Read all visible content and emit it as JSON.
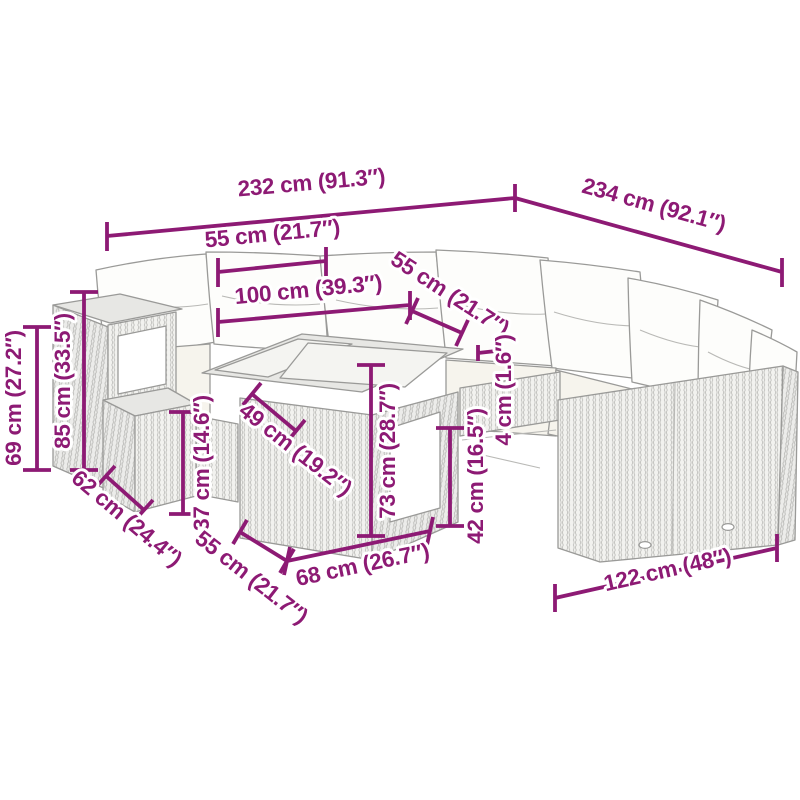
{
  "diagram": {
    "type": "furniture-dimension-diagram",
    "subject": "poly rattan garden corner sofa set with table, cushions and stool",
    "colors": {
      "accent": "#8d1a74",
      "line_art": "#9a9a98",
      "background": "#ffffff"
    },
    "dimensions": [
      {
        "name": "overall-width-left",
        "label": "232 cm (91.3″)"
      },
      {
        "name": "overall-width-right",
        "label": "234 cm (92.1″)"
      },
      {
        "name": "glass-top-width",
        "label": "55 cm (21.7″)"
      },
      {
        "name": "table-top-length",
        "label": "100 cm (39.3″)"
      },
      {
        "name": "glass-top-depth",
        "label": "55 cm (21.7″)"
      },
      {
        "name": "top-thickness",
        "label": "4 cm (1.6″)"
      },
      {
        "name": "armrest-height",
        "label": "69 cm (27.2″)"
      },
      {
        "name": "back-height",
        "label": "85 cm (33.5″)"
      },
      {
        "name": "stool-depth",
        "label": "62 cm (24.4″)"
      },
      {
        "name": "stool-height",
        "label": "37 cm (14.6″)"
      },
      {
        "name": "shelf-depth",
        "label": "49 cm (19.2″)"
      },
      {
        "name": "table-depth",
        "label": "55 cm (21.7″)"
      },
      {
        "name": "table-width",
        "label": "68 cm (26.7″)"
      },
      {
        "name": "table-height",
        "label": "73 cm (28.7″)"
      },
      {
        "name": "seat-height",
        "label": "42 cm (16.5″)"
      },
      {
        "name": "sofa-section-length",
        "label": "122 cm (48″)"
      }
    ]
  }
}
